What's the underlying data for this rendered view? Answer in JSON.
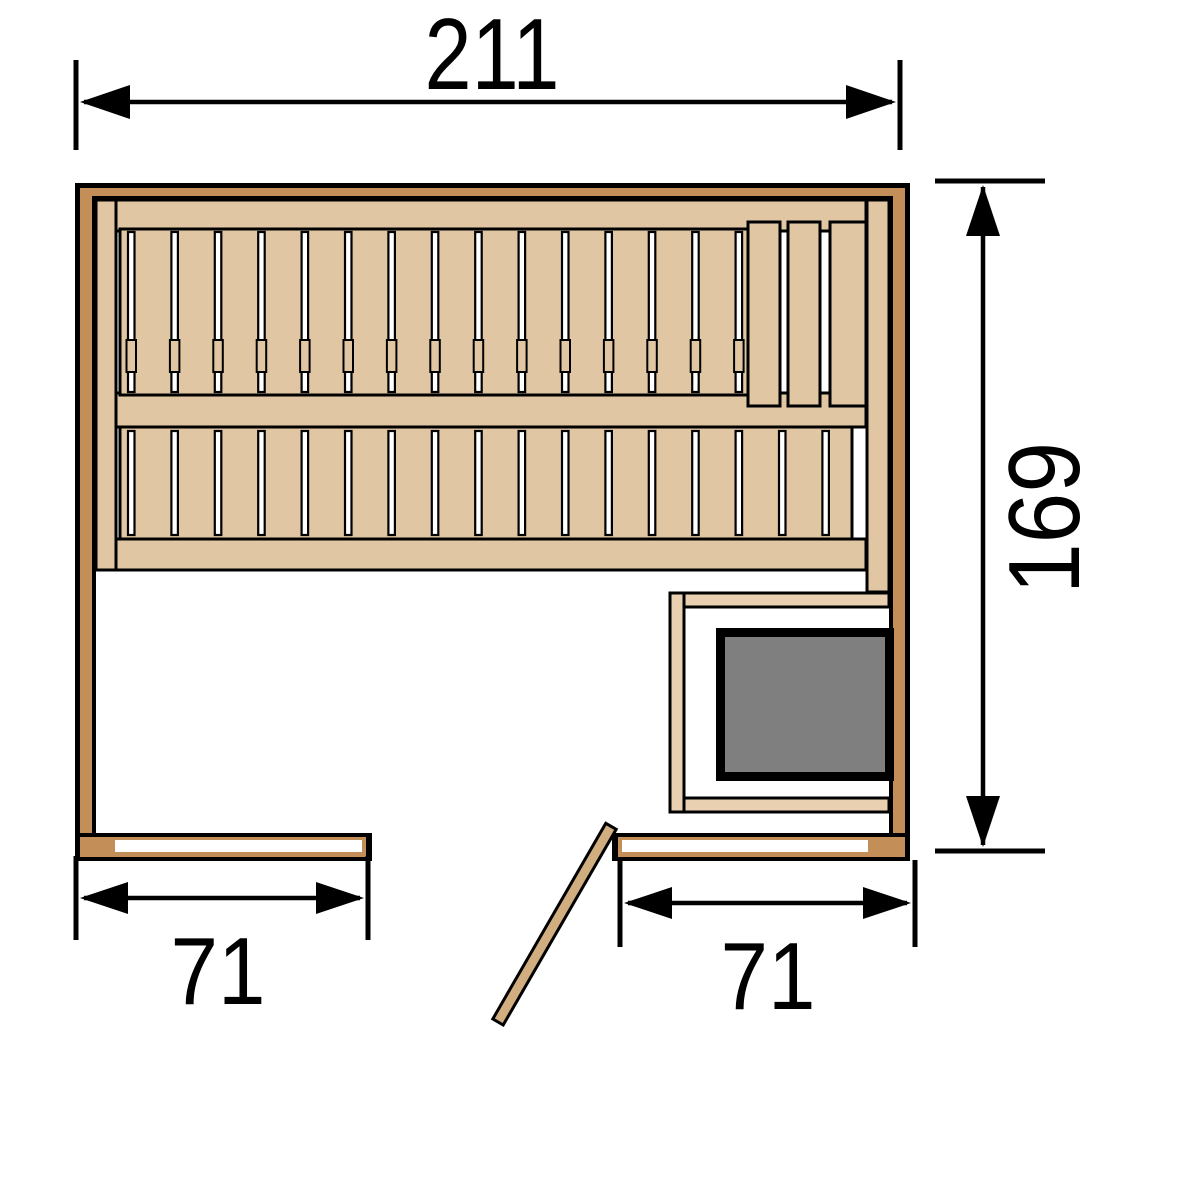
{
  "diagram": {
    "type": "sauna-floor-plan",
    "dimensions": {
      "overall_width": {
        "label": "211"
      },
      "overall_depth": {
        "label": "169"
      },
      "left_wall_segment": {
        "label": "71"
      },
      "right_wall_segment": {
        "label": "71"
      }
    },
    "colors": {
      "wall": "#C38E58",
      "bench": "#E1C6A3",
      "guard": "#E8D0B0",
      "heater": "#7F7F7F",
      "door": "#D1AE80",
      "line": "#000000"
    }
  }
}
